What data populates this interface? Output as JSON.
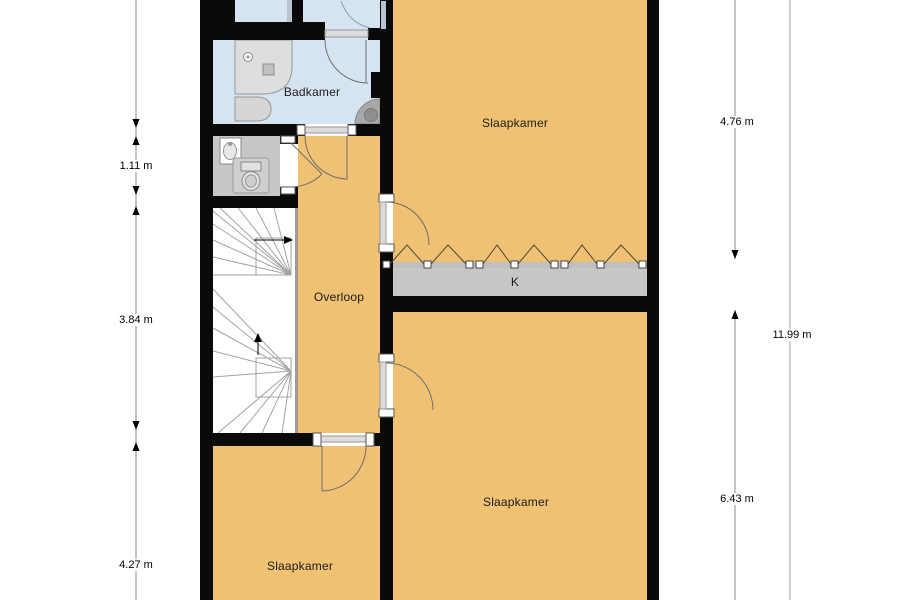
{
  "plan": {
    "rooms": {
      "badkamer": "Badkamer",
      "slaapkamer_top": "Slaapkamer",
      "overloop": "Overloop",
      "kast": "K",
      "slaapkamer_right": "Slaapkamer",
      "slaapkamer_left": "Slaapkamer"
    },
    "dimensions": {
      "left_segment_1": "1.11 m",
      "left_segment_2": "3.84 m",
      "left_segment_3": "4.27 m",
      "right_top": "4.76 m",
      "right_total": "11.99 m",
      "right_bottom": "6.43 m"
    },
    "colors": {
      "wall": "#0a0a0a",
      "room_orange": "#f0c173",
      "room_blue": "#d6e4f1",
      "room_gray": "#c7c7c7",
      "background": "#ffffff"
    }
  }
}
